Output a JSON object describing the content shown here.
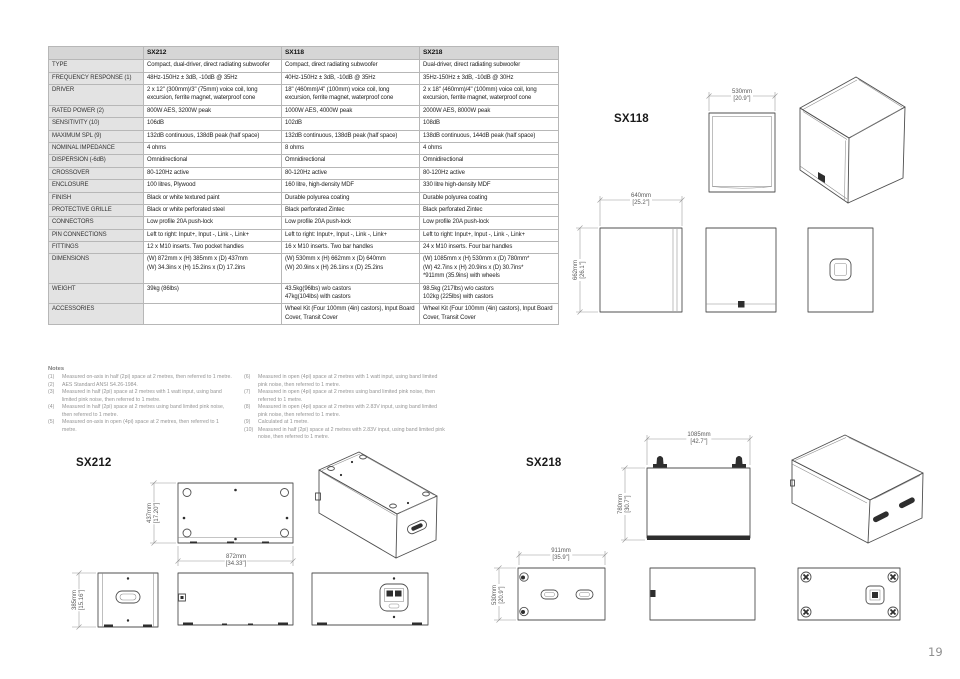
{
  "table": {
    "columns": [
      "",
      "SX212",
      "SX118",
      "SX218"
    ],
    "rows": [
      {
        "label": "TYPE",
        "sx212": "Compact, dual-driver, direct radiating subwoofer",
        "sx118": "Compact, direct radiating subwoofer",
        "sx218": "Dual-driver, direct radiating subwoofer"
      },
      {
        "label": "FREQUENCY RESPONSE (1)",
        "sx212": "48Hz-150Hz ± 3dB, -10dB @ 35Hz",
        "sx118": "40Hz-150Hz ± 3dB, -10dB @ 35Hz",
        "sx218": "35Hz-150Hz ± 3dB, -10dB @ 30Hz"
      },
      {
        "label": "DRIVER",
        "sx212": "2 x 12\" (300mm)/3\" (75mm) voice coil, long excursion, ferrite magnet, waterproof cone",
        "sx118": "18\" (460mm)/4\" (100mm) voice coil, long excursion, ferrite magnet, waterproof cone",
        "sx218": "2 x 18\" (460mm)/4\" (100mm) voice coil, long excursion, ferrite magnet, waterproof cone"
      },
      {
        "label": "RATED POWER (2)",
        "sx212": "800W AES, 3200W peak",
        "sx118": "1000W AES, 4000W peak",
        "sx218": "2000W AES, 8000W peak"
      },
      {
        "label": "SENSITIVITY (10)",
        "sx212": "106dB",
        "sx118": "102dB",
        "sx218": "108dB"
      },
      {
        "label": "MAXIMUM SPL (9)",
        "sx212": "132dB continuous, 138dB peak (half space)",
        "sx118": "132dB continuous, 138dB peak (half space)",
        "sx218": "138dB continuous, 144dB peak (half space)"
      },
      {
        "label": "NOMINAL IMPEDANCE",
        "sx212": "4 ohms",
        "sx118": "8 ohms",
        "sx218": "4 ohms"
      },
      {
        "label": "DISPERSION (-6dB)",
        "sx212": "Omnidirectional",
        "sx118": "Omnidirectional",
        "sx218": "Omnidirectional"
      },
      {
        "label": "CROSSOVER",
        "sx212": "80-120Hz active",
        "sx118": "80-120Hz active",
        "sx218": "80-120Hz active"
      },
      {
        "label": "ENCLOSURE",
        "sx212": "100 litres, Plywood",
        "sx118": "160 litre, high-density MDF",
        "sx218": "330 litre high-density MDF"
      },
      {
        "label": "FINISH",
        "sx212": "Black or white textured paint",
        "sx118": "Durable polyurea coating",
        "sx218": "Durable polyurea coating"
      },
      {
        "label": "PROTECTIVE GRILLE",
        "sx212": "Black or white perforated steel",
        "sx118": "Black perforated Zintec",
        "sx218": "Black perforated Zintec"
      },
      {
        "label": "CONNECTORS",
        "sx212": "Low profile 20A push-lock",
        "sx118": "Low profile 20A push-lock",
        "sx218": "Low profile 20A push-lock"
      },
      {
        "label": "PIN CONNECTIONS",
        "sx212": "Left to right: Input+, Input -, Link -, Link+",
        "sx118": "Left to right: Input+, Input -, Link -, Link+",
        "sx218": "Left to right: Input+, Input -, Link -, Link+"
      },
      {
        "label": "FITTINGS",
        "sx212": "12 x M10 inserts. Two pocket handles",
        "sx118": "16 x M10 inserts. Two bar handles",
        "sx218": "24 x M10 inserts. Four bar handles"
      },
      {
        "label": "DIMENSIONS",
        "sx212": "(W) 872mm x (H) 385mm x (D) 437mm\n(W) 34.3ins x (H) 15.2ins x (D) 17.2ins",
        "sx118": "(W) 530mm x (H) 662mm x (D) 640mm\n(W) 20.9ins x (H) 26.1ins x (D) 25.2ins",
        "sx218": "(W) 1085mm x (H) 530mm x (D) 780mm*\n(W) 42.7ins x (H) 20.9ins x (D) 30.7ins*\n*911mm (35.9ins) with wheels"
      },
      {
        "label": "WEIGHT",
        "sx212": "39kg (86lbs)",
        "sx118": "43.5kg(96lbs) w/o castors\n47kg(104lbs) with castors",
        "sx218": "98.5kg (217lbs) w/o castors\n102kg (225lbs) with castors"
      },
      {
        "label": "ACCESSORIES",
        "sx212": "",
        "sx118": "Wheel Kit (Four 100mm (4in) castors), Input Board Cover, Transit Cover",
        "sx218": "Wheel Kit (Four 100mm (4in) castors), Input Board Cover, Transit Cover"
      }
    ]
  },
  "notes": {
    "title": "Notes",
    "items": [
      {
        "num": "(1)",
        "text": "Measured on-axis in half (2pi) space at 2 metres, then referred to 1 metre."
      },
      {
        "num": "(2)",
        "text": "AES Standard ANSI S4.26-1984."
      },
      {
        "num": "(3)",
        "text": "Measured in half (2pi) space at 2 metres with 1 watt input, using band limited pink noise, then referred to 1 metre."
      },
      {
        "num": "(4)",
        "text": "Measured in half (2pi) space at 2 metres using band limited pink noise, then referred to 1 metre."
      },
      {
        "num": "(5)",
        "text": "Measured on-axis in open (4pi) space at 2 metres, then referred to 1 metre."
      },
      {
        "num": "(6)",
        "text": "Measured in open (4pi) space at 2 metres with 1 watt input, using band limited pink noise, then referred to 1 metre."
      },
      {
        "num": "(7)",
        "text": "Measured in open (4pi) space at 2 metres using band limited pink noise, then referred to 1 metre."
      },
      {
        "num": "(8)",
        "text": "Measured in open (4pi) space at 2 metres with 2.83V input, using band limited pink noise, then referred to 1 metre."
      },
      {
        "num": "(9)",
        "text": "Calculated at 1 metre."
      },
      {
        "num": "(10)",
        "text": "Measured in half (2pi) space at 2 metres with 2.83V input, using band limited pink noise, then referred to 1 metre."
      }
    ]
  },
  "drawings": {
    "sx118": {
      "label": "SX118",
      "dim_width": "530mm\n[20.9\"]",
      "dim_depth": "640mm\n[25.2\"]",
      "dim_height": "662mm\n[26.1\"]"
    },
    "sx212": {
      "label": "SX212",
      "dim_depth": "437mm\n[17.20\"]",
      "dim_width": "872mm\n[34.33\"]",
      "dim_height": "385mm\n[15.16\"]"
    },
    "sx218": {
      "label": "SX218",
      "dim_width": "1085mm\n[42.7\"]",
      "dim_height": "780mm\n[30.7\"]",
      "dim_depth": "911mm\n[35.9\"]",
      "dim_side_height": "530mm\n[20.9\"]"
    }
  },
  "page_number": "19",
  "colors": {
    "table_header_bg": "#d6d6d6",
    "table_label_bg": "#e3e3e3",
    "drawing_line": "#4f4f4f",
    "dim_line": "#979797",
    "note_text": "#949494"
  }
}
